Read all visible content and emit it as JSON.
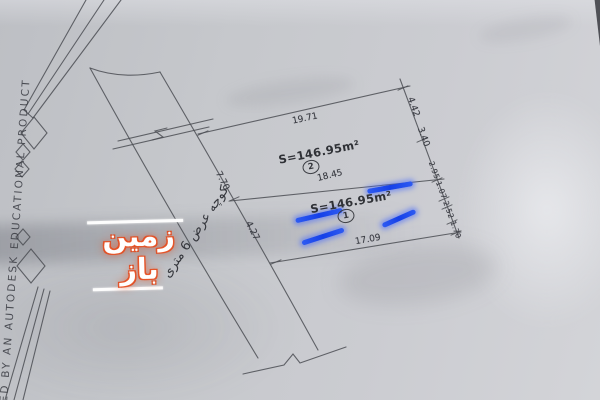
{
  "stamp": {
    "text": "ED BY AN AUTODESK EDUCATIONAL PRODUCT"
  },
  "watermark": {
    "text": "زمین باز",
    "accent_color": "#dd4f28"
  },
  "road": {
    "label": "کوچه عرض 6 متری"
  },
  "plots": {
    "plot2": {
      "area": "S=146.95m²",
      "number": "2"
    },
    "plot1": {
      "area": "S=146.95m²",
      "number": "1"
    }
  },
  "dimensions": {
    "top_edge": "19.71",
    "divider": "18.45",
    "bottom_edge": "17.09",
    "frontage_upper": "7.70",
    "frontage_lower": "4.27",
    "right_seg1": "4.42",
    "right_seg2": "3.40",
    "right_chain": "2.95 1.07 2.52 1.70"
  },
  "colors": {
    "highlight": "#1540e8",
    "paper": "#c6c8cc",
    "line": "#4b4d54"
  }
}
